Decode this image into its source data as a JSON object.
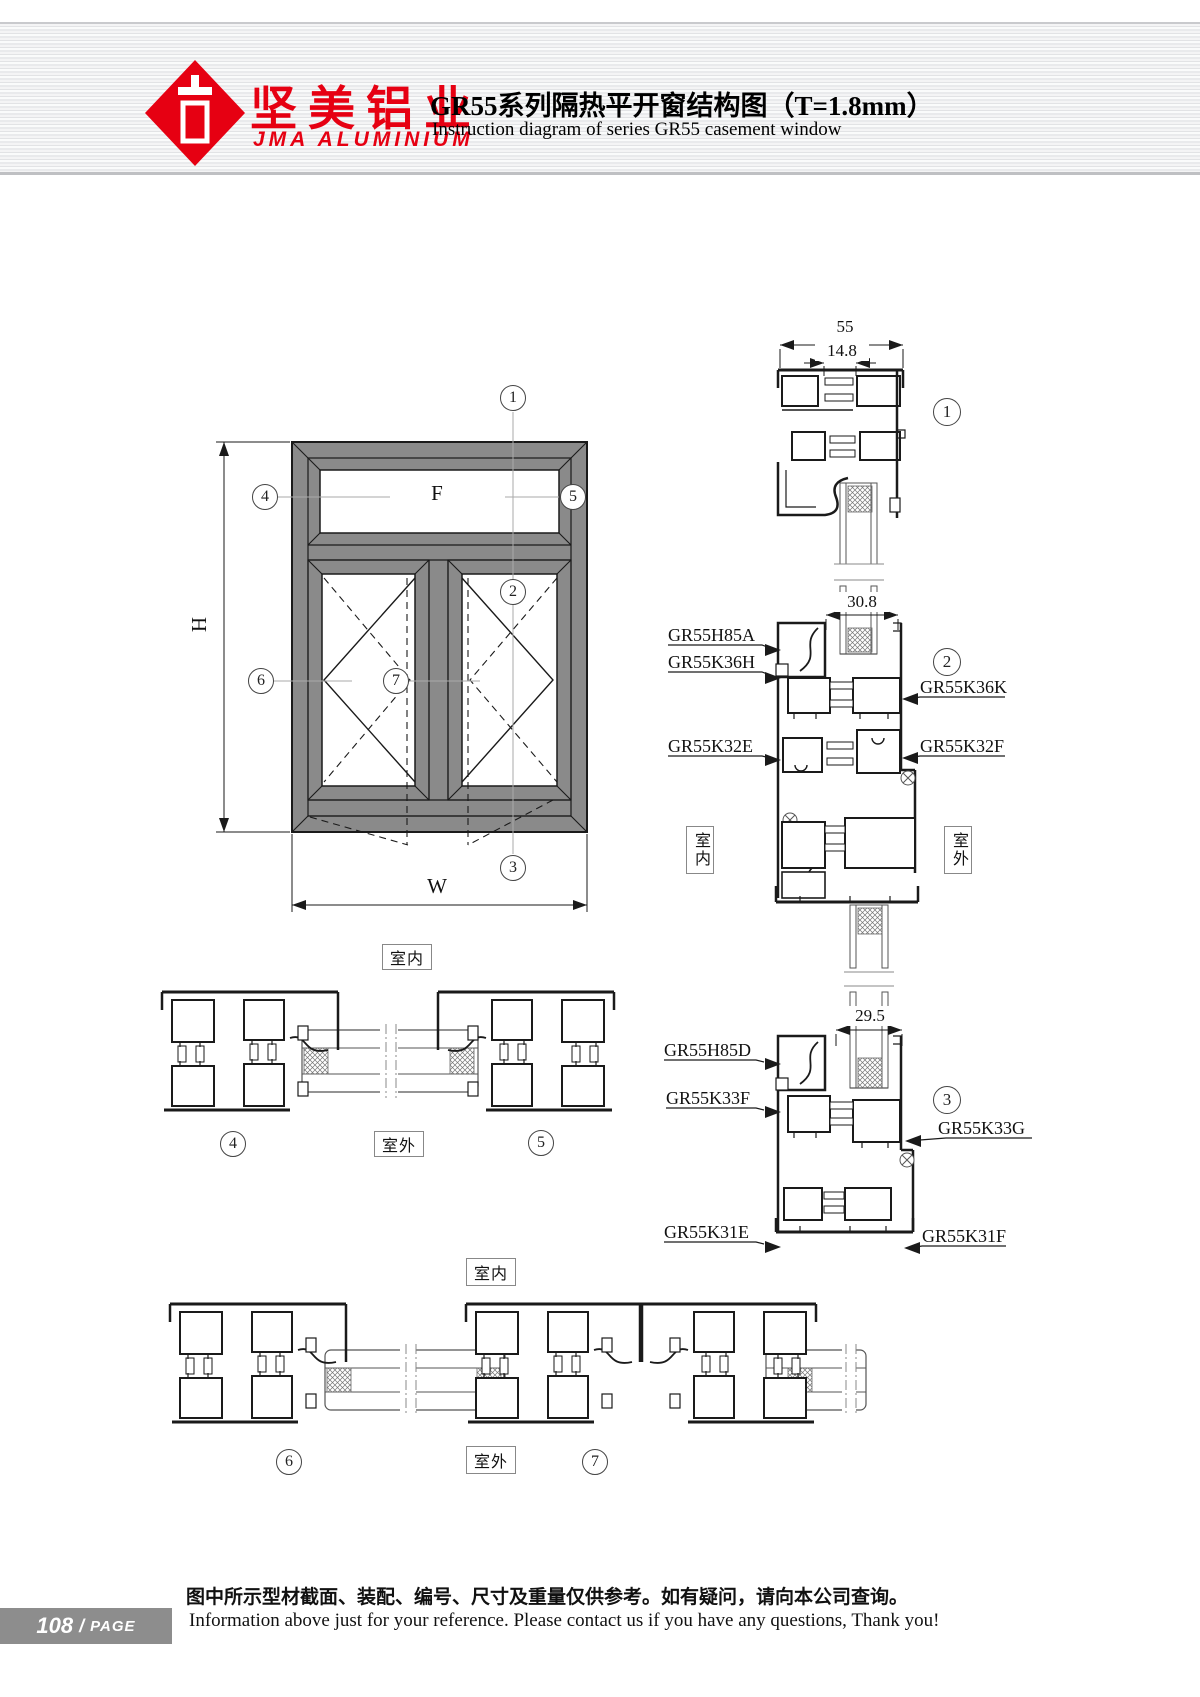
{
  "header": {
    "brand_cn": "坚美铝业",
    "brand_en": "JMA ALUMINIUM",
    "title": "GR55系列隔热平开窗结构图（T=1.8mm）",
    "subtitle": "Instruction diagram of series GR55 casement window"
  },
  "elevation": {
    "fixed": "F",
    "dim_h": "H",
    "dim_w": "W"
  },
  "callouts": [
    "1",
    "2",
    "3",
    "4",
    "5",
    "6",
    "7"
  ],
  "zones": {
    "indoor": "室内",
    "outdoor": "室外"
  },
  "dims": {
    "s1_overall": "55",
    "s1_inner": "14.8",
    "s2_glass": "30.8",
    "s3_glass": "29.5"
  },
  "profiles": {
    "s2_left": [
      "GR55H85A",
      "GR55K36H",
      "GR55K32E"
    ],
    "s2_right": [
      "GR55K36K",
      "GR55K32F"
    ],
    "s3_left": [
      "GR55H85D",
      "GR55K33F",
      "GR55K31E"
    ],
    "s3_right": [
      "GR55K33G",
      "GR55K31F"
    ]
  },
  "footer": {
    "page_num": "108",
    "page_slash": "/",
    "page_word": "PAGE",
    "note_cn": "图中所示型材截面、装配、编号、尺寸及重量仅供参考。如有疑问，请向本公司查询。",
    "note_en": "Information above just for your reference. Please contact us if you have any questions, Thank you!"
  },
  "colors": {
    "accent": "#e60012",
    "frame_gray": "#8a8a8a",
    "line": "#1a1a1a"
  }
}
